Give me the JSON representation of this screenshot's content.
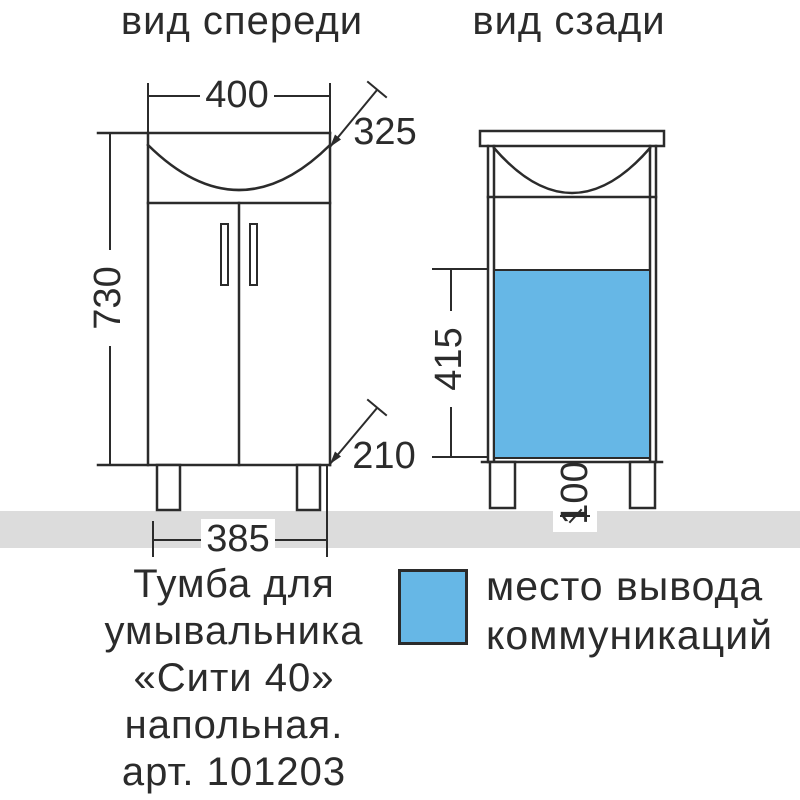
{
  "drawing": {
    "front_view": {
      "title": "вид спереди",
      "dim_top_width": "400",
      "dim_depth": "325",
      "dim_height": "730",
      "dim_leg_offset": "210",
      "dim_bottom_width": "385"
    },
    "back_view": {
      "title": "вид сзади",
      "dim_comm_zone_height": "415",
      "dim_leg_height": "100"
    },
    "legend": {
      "lines": [
        "место вывода",
        "коммуникаций"
      ]
    },
    "caption": {
      "lines": [
        "Тумба для",
        "умывальника",
        "«Сити 40»",
        "напольная.",
        "арт. 101203"
      ]
    },
    "colors": {
      "accent_blue": "#66b7e6",
      "line": "#2b2b2b",
      "floor_gray": "#dcdcdc"
    }
  }
}
